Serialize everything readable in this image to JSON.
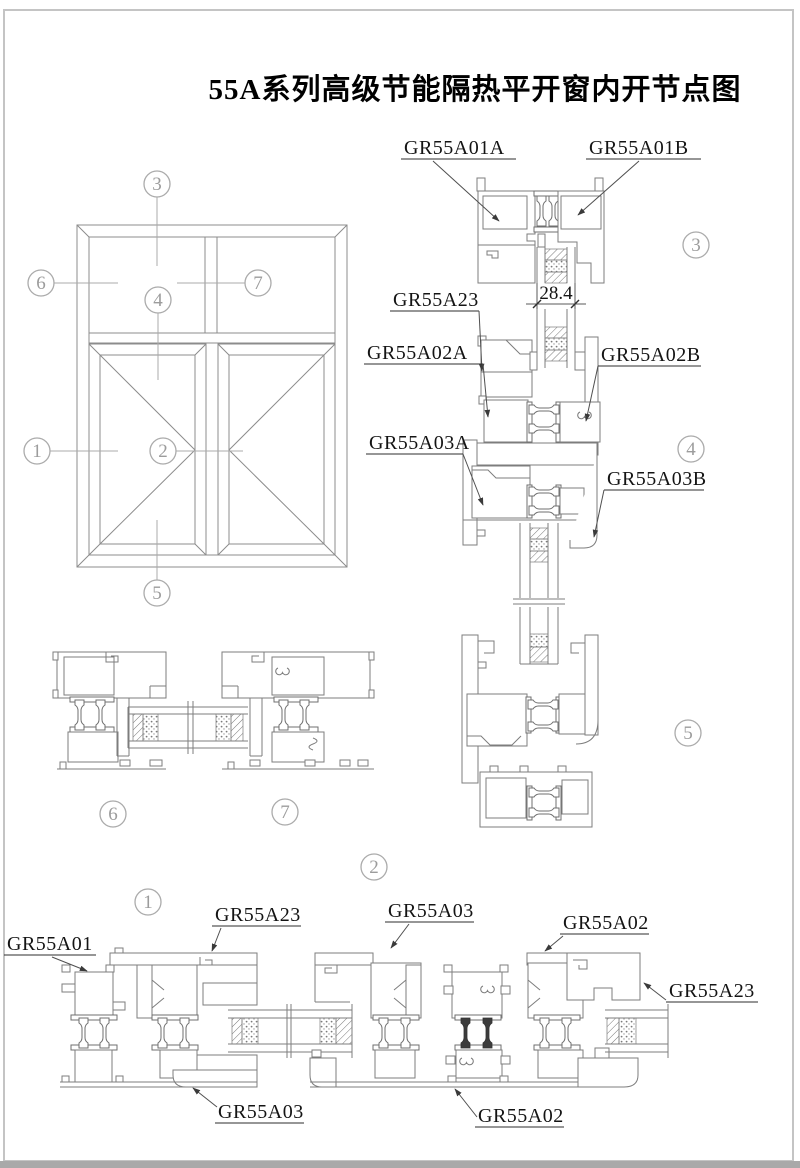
{
  "title": "55A系列高级节能隔热平开窗内开节点图",
  "callouts": {
    "n1": "1",
    "n2": "2",
    "n3": "3",
    "n4": "4",
    "n5": "5",
    "n6": "6",
    "n7": "7"
  },
  "labels": {
    "a01a": "GR55A01A",
    "a01b": "GR55A01B",
    "a23": "GR55A23",
    "a02a": "GR55A02A",
    "a02b": "GR55A02B",
    "a03a": "GR55A03A",
    "a03b": "GR55A03B",
    "a01": "GR55A01",
    "a02": "GR55A02",
    "a03": "GR55A03"
  },
  "dimension": {
    "glazing_width": "28.4"
  },
  "colors": {
    "profile_line": "#7d7d7d",
    "leader_line": "#4f4f4f",
    "text": "#141414",
    "callout": "#ababab",
    "page_border": "#c4c4c4",
    "page_footer": "#a9a9a9"
  }
}
